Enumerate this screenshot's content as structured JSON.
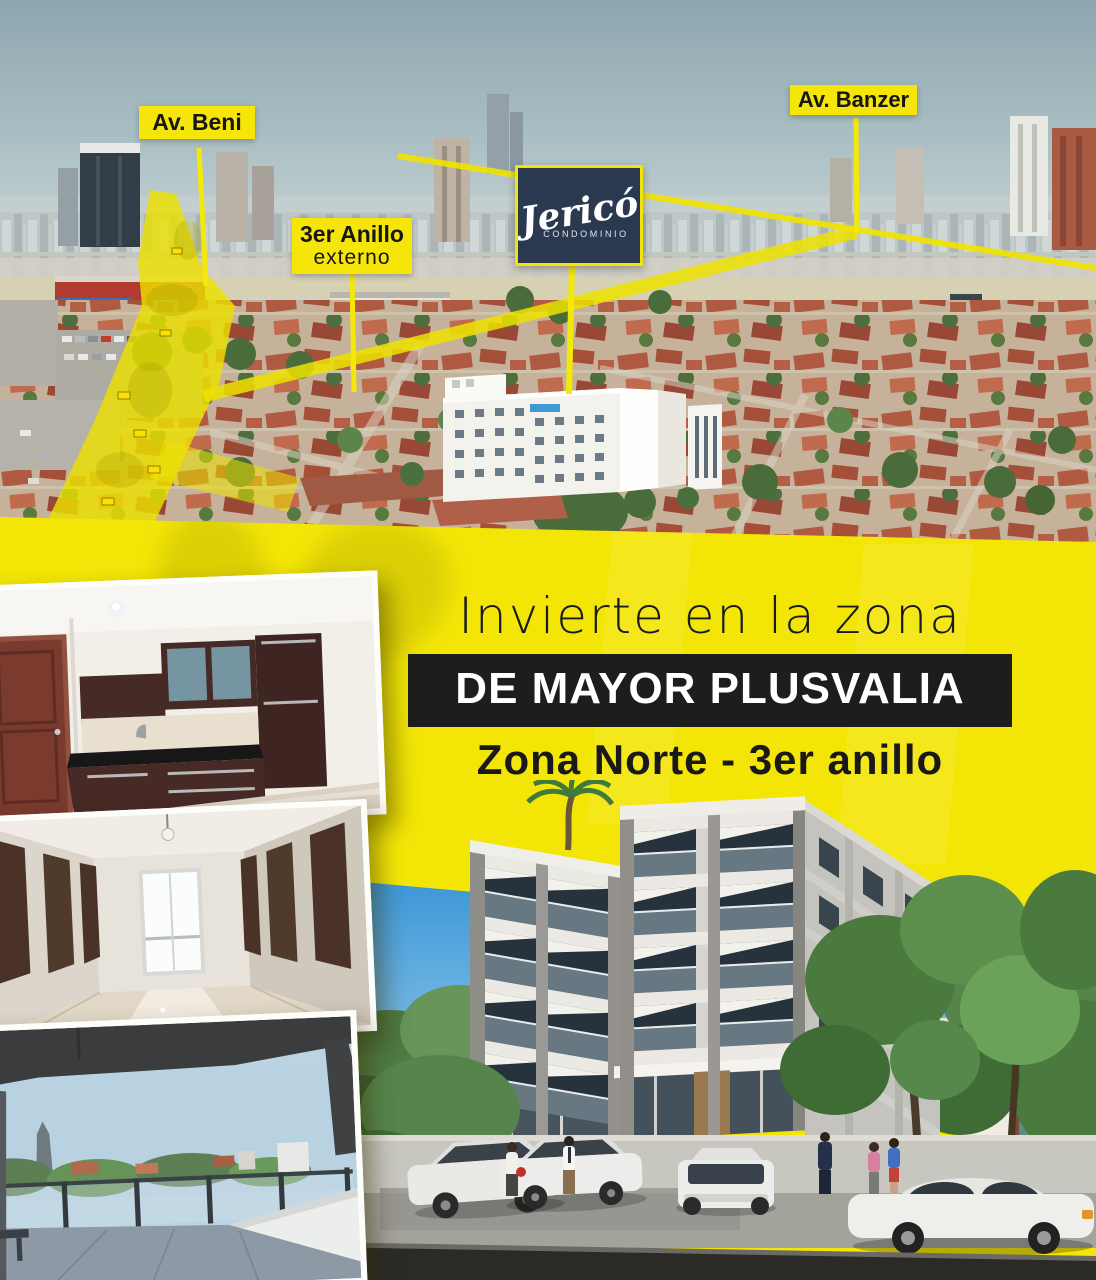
{
  "poster": {
    "map": {
      "label_av_beni": "Av. Beni",
      "label_av_banzer": "Av. Banzer",
      "label_anillo_line1": "3er Anillo",
      "label_anillo_line2": "externo",
      "logo_name": "Jericó",
      "logo_subtitle": "CONDOMINIO"
    },
    "promo": {
      "line1": "Invierte en la zona",
      "line2": "DE MAYOR PLUSVALIA",
      "line3": "Zona Norte - 3er anillo"
    },
    "colors": {
      "accent_yellow": "#f3e607",
      "label_yellow": "#f6e509",
      "bar_black": "#1d1d1d",
      "logo_navy": "#2b3950",
      "render_sky_blue": "#49a0d8"
    }
  }
}
